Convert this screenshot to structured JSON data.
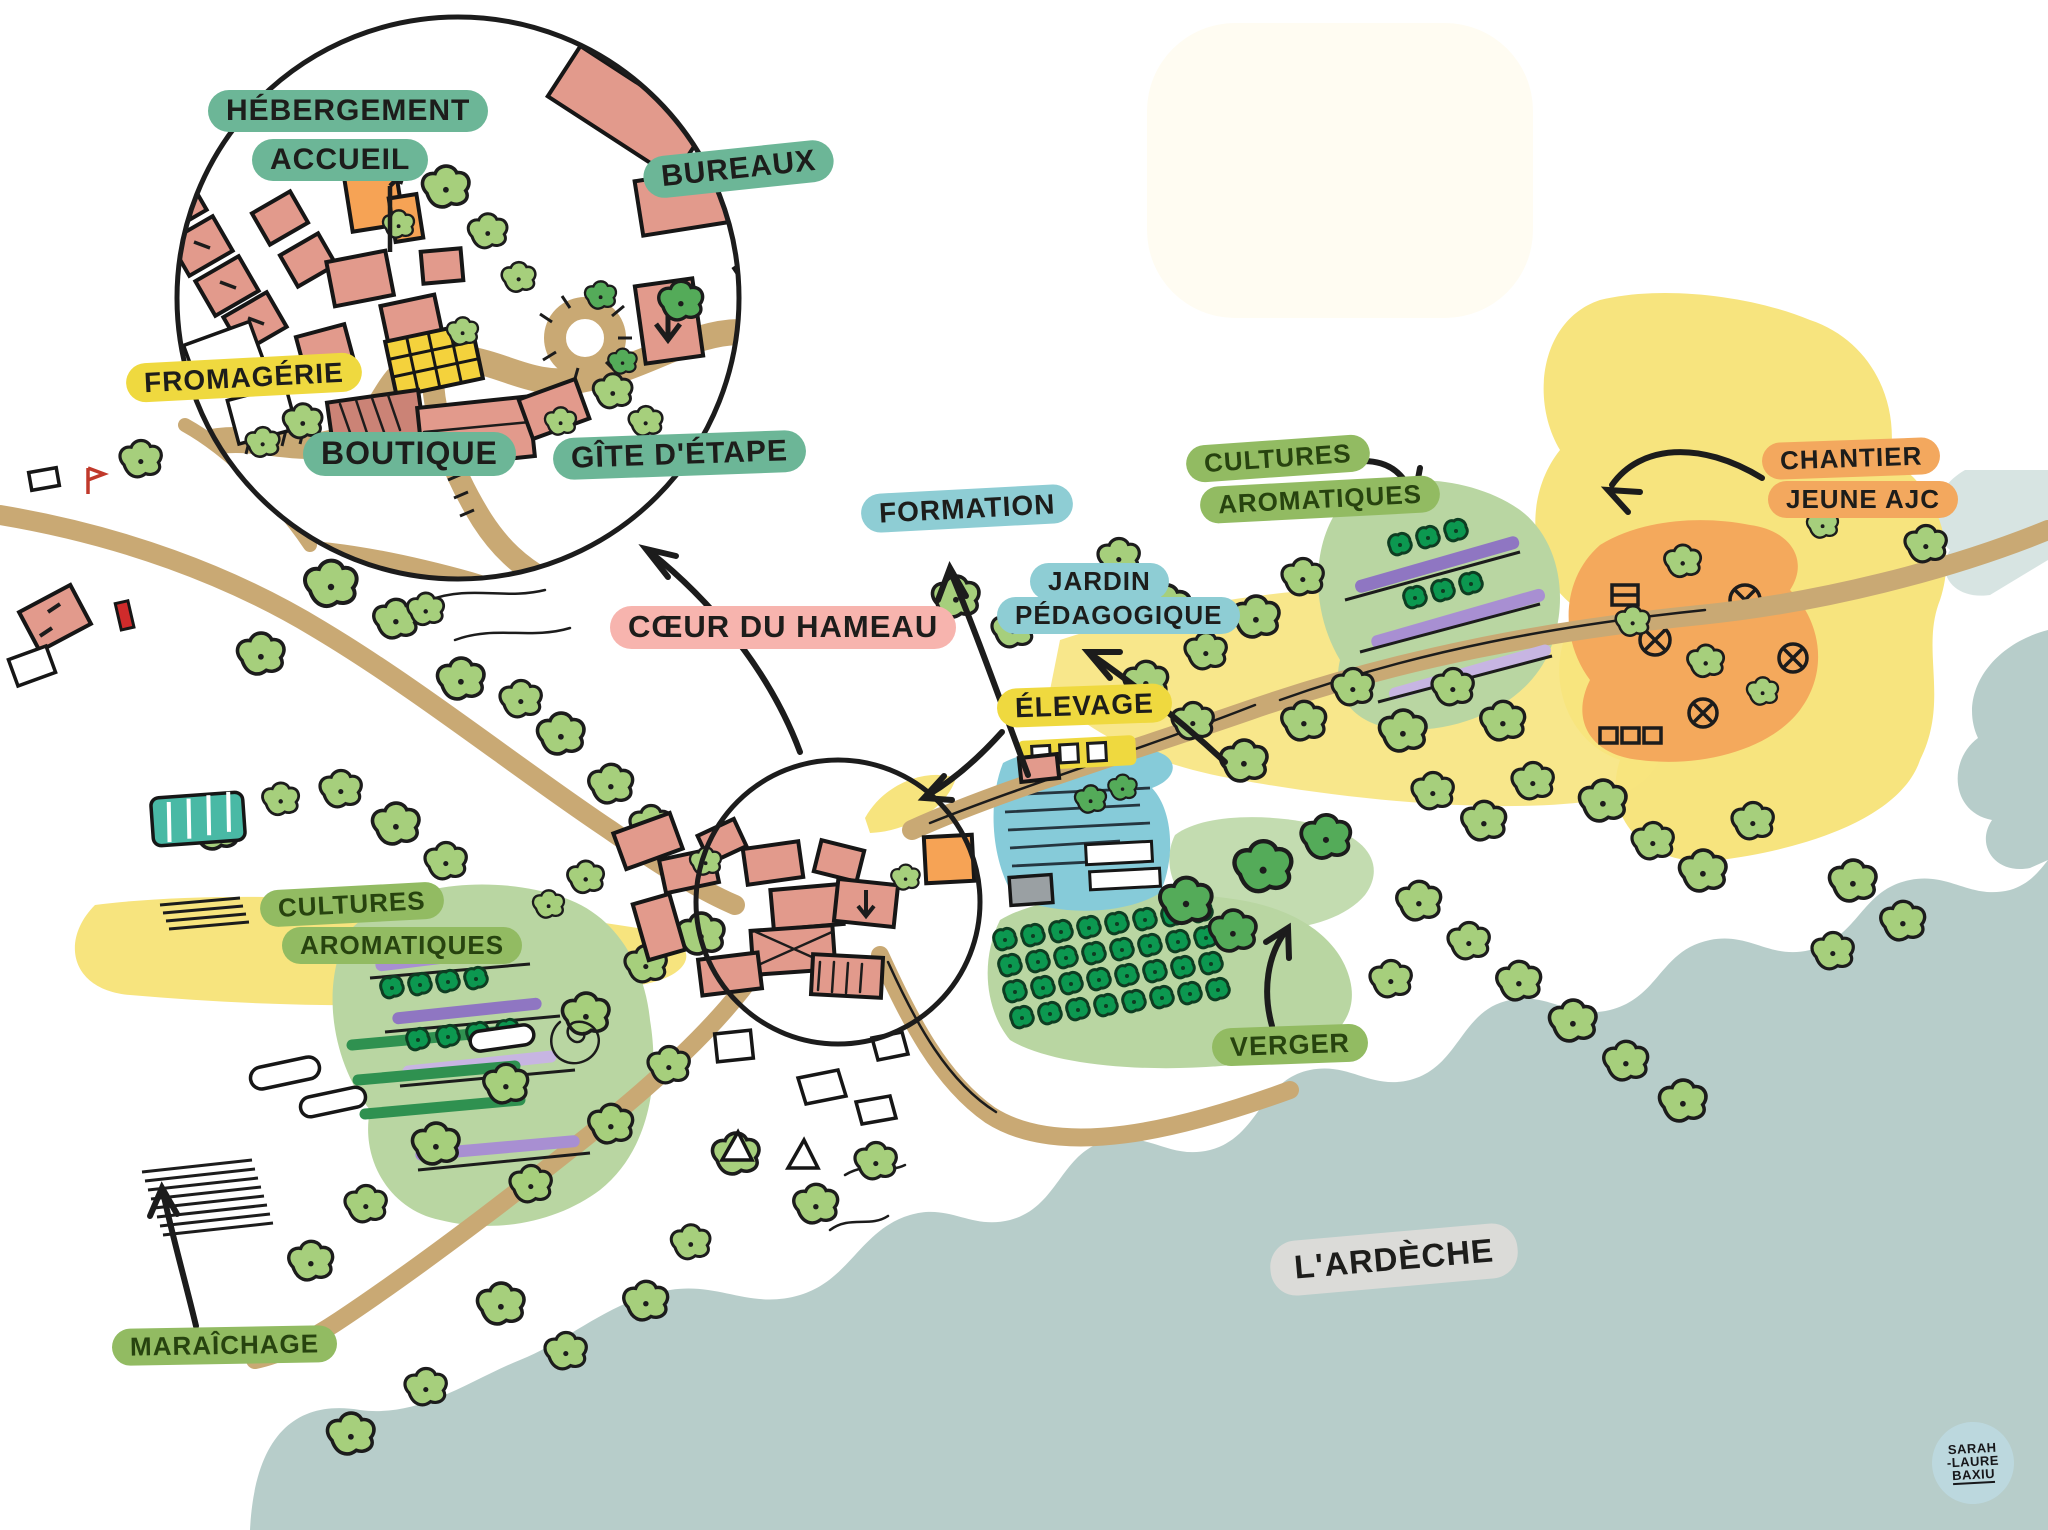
{
  "inset": {
    "labels": {
      "hebergement_line1": "HÉBERGEMENT",
      "hebergement_line2": "ACCUEIL",
      "bureaux": "BUREAUX",
      "fromagerie": "FROMAGÉRIE",
      "boutique": "BOUTIQUE",
      "gite_detape": "GÎTE D'ÉTAPE"
    }
  },
  "zones": {
    "coeur_du_hameau": "CŒUR DU HAMEAU",
    "formation": "FORMATION",
    "jardin_line1": "JARDIN",
    "jardin_line2": "PÉDAGOGIQUE",
    "elevage": "ÉLEVAGE",
    "cultures_right_line1": "CULTURES",
    "cultures_right_line2": "AROMATIQUES",
    "chantier_line1": "CHANTIER",
    "chantier_line2": "JEUNE AJC",
    "cultures_left_line1": "CULTURES",
    "cultures_left_line2": "AROMATIQUES",
    "verger": "VERGER",
    "maraichage": "MARAÎCHAGE"
  },
  "river_label": "L'ARDÈCHE",
  "signature": {
    "line1": "SARAH",
    "line2": "-LAURE",
    "line3": "BAXIU"
  },
  "palette": {
    "label_green": "#6cb697",
    "label_yellow": "#efd93f",
    "label_pink": "#f7b4ae",
    "label_blue": "#8ecdd4",
    "label_olive": "#92bb62",
    "label_orange": "#f3a85e",
    "label_gray": "#dbdbd8",
    "river": "#b7cdca",
    "road": "#c9a974",
    "building": "#e29a8c",
    "tree_light": "#a6cf7c",
    "tree_dark": "#0c9850",
    "field_yellow": "#f7e47e",
    "zone_green": "#b9d6a2",
    "zone_orange": "#f4a95c",
    "zone_blue": "#86cbd9",
    "stripe_purple": "#a88fd2",
    "cream_block": "#fffcf2",
    "signature_blue": "#bcd8de"
  }
}
